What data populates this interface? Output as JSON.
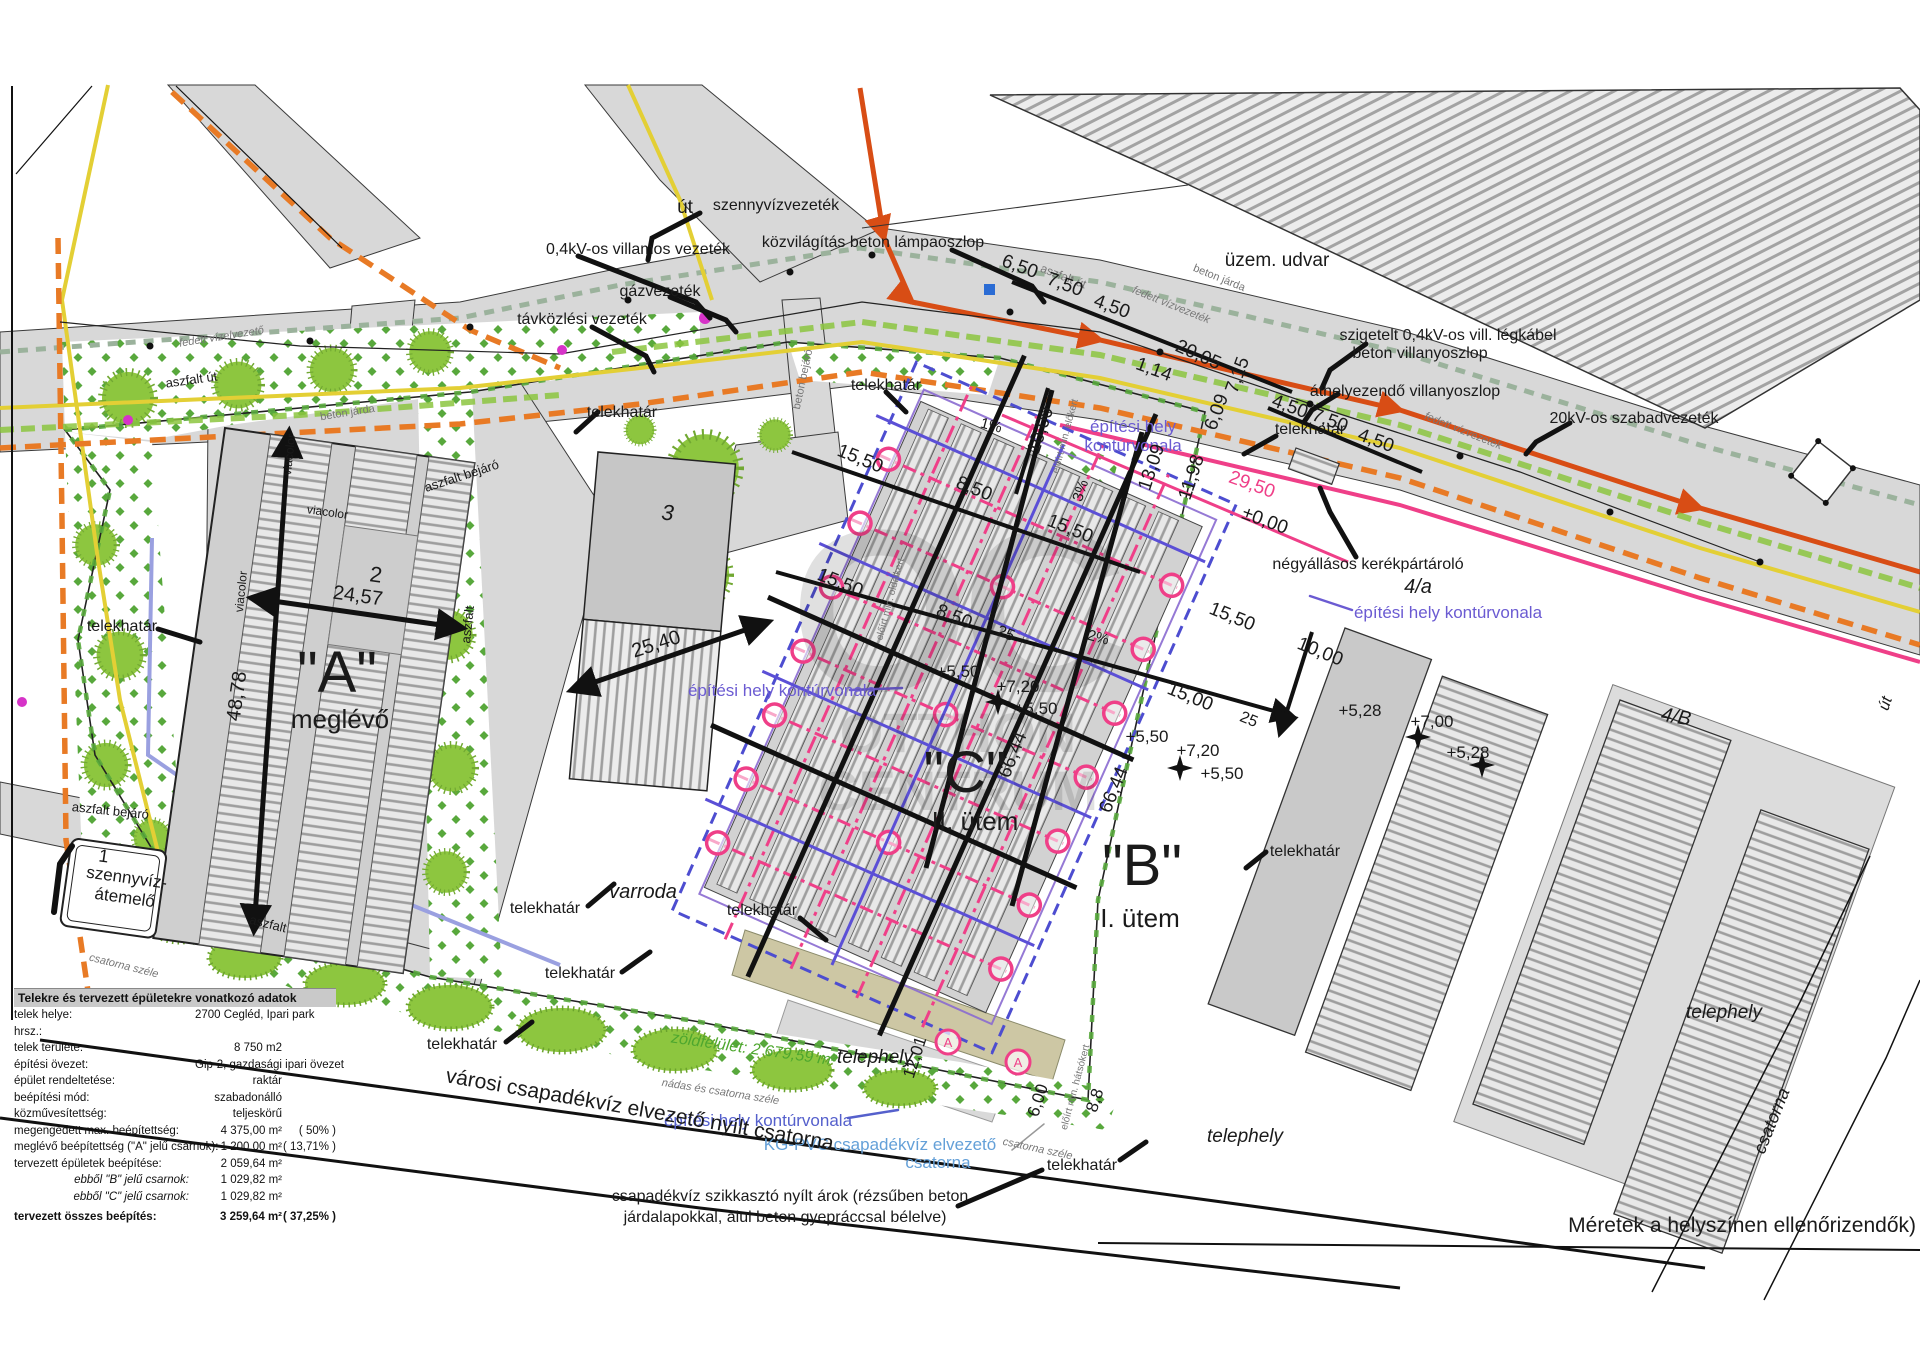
{
  "colors": {
    "accent_pink": "#ef3f88",
    "purple": "#6b5bd2",
    "blue_dash": "#4d4dd0",
    "kg_blue": "#64a0d8",
    "green_text": "#4ea72e",
    "utility_yellow": "#e3cf35",
    "utility_orange": "#e87a25",
    "utility_red": "#d84d15",
    "vegetation_green": "#8dc63f",
    "road_gray": "#d8d8d8"
  },
  "watermark": {
    "big": "OC",
    "l1": "OTTHON",
    "l2": "CENTRUM"
  },
  "labels": {
    "ut": "út",
    "ut_right": "út",
    "szennyviz": "szennyvízvezeték",
    "villamos": "0,4kV-os villamos vezeték",
    "gaz": "gázvezeték",
    "tavkozlesi": "távközlési vezeték",
    "kozvilagitas": "közvilágítás beton lámpaoszlop",
    "uzem_udvar": "üzem. udvar",
    "szigetelt1": "szigetelt 0,4kV-os vill. légkábel",
    "szigetelt2": "beton villanyoszlop",
    "athelyezendo": "áthelyezendő villanyoszlop",
    "szabadvezetek": "20kV-os szabadvezeték",
    "telekhatar": "telekhatár",
    "epitesi_hely": "építési hely kontúrvonala",
    "epitesi_hely1": "építési hely",
    "epitesi_hely2": "kontúrvonala",
    "negyallasos": "négyállásos kerékpártároló",
    "varroda": "varroda",
    "telephely": "telephely",
    "csatorna": "csatorna",
    "varosi": "városi csapadékvíz elvezető nyílt csatorna",
    "kgpvc1": "KG-PVC csapadékvíz elvezető",
    "kgpvc2": "csatorna",
    "szikkaszto1": "csapadékvíz szikkasztó nyílt árok (rézsűben beton",
    "szikkaszto2": "járdalapokkal, alul beton gyepráccsal bélelve)",
    "zoldfelulet": "zöldfelület: 2 679,59 m²",
    "nadas": "nádas és csatorna széle",
    "csatorna_szele": "csatorna széle",
    "meretek": "Méretek a helyszínen ellenőrizendők)",
    "aszfalt": "aszfalt",
    "aszfalt_ut": "aszfalt út",
    "aszfalt_bejaro": "aszfalt bejáró",
    "beton_jarda": "beton járda",
    "beton_bejaro": "beton bejáró",
    "viacolor": "viacolor",
    "fedett_vizvezetek": "fedett vízvezeték",
    "fedett_vizelvezeto": "fedett vízelvezető",
    "elokert": "előírt min. előkert",
    "oldalkert": "előírt min. oldalkert",
    "hatsokert": "előírt min. hátsókert",
    "marker_a": "A"
  },
  "buildings": {
    "a": "\"A\"",
    "a_sub": "meglévő",
    "b": "\"B\"",
    "b_sub": "I. ütem",
    "c": "\"C\"",
    "c_sub": "II. ütem",
    "n1": "1",
    "n2": "2",
    "n3": "3",
    "n4a": "4/a",
    "n4b": "4/B",
    "szv1": "szennyvíz-",
    "szv2": "átemelő"
  },
  "dims": {
    "d650": "6,50",
    "d750": "7,50",
    "d450": "4,50",
    "d2005": "20,05",
    "d715": "7,15",
    "d114": "1,14",
    "d1000": "10,00",
    "d1309": "13,09",
    "d1198": "11,98",
    "d2950": "29,50",
    "d000": "±0,00",
    "d609": "6,09",
    "d1550": "15,50",
    "d850": "8,50",
    "d25": "25",
    "d1500": "15,00",
    "p550": "+5,50",
    "p720": "+7,20",
    "d6644": "66,44",
    "d4878": "48,78",
    "d2457": "24,57",
    "d2540": "25,40",
    "p528": "+5,28",
    "p700": "+7,00",
    "d600": "6,00",
    "d1201": "12,01",
    "d88": "8,8",
    "pct1": "1%",
    "pct2": "2%",
    "pct3": "3%"
  },
  "table": {
    "title": "Telekre és tervezett épületekre vonatkozó adatok",
    "rows": [
      {
        "l": "telek helye:",
        "v": "2700 Cegléd, Ipari park",
        "p": ""
      },
      {
        "l": "hrsz.:",
        "v": "",
        "p": ""
      },
      {
        "l": "telek területe:",
        "v": "8 750 m2",
        "p": ""
      },
      {
        "l": "építési övezet:",
        "v": "Gip-2, gazdasági ipari övezet",
        "p": ""
      },
      {
        "l": "épület rendeltetése:",
        "v": "raktár",
        "p": ""
      },
      {
        "l": "beépítési mód:",
        "v": "szabadonálló",
        "p": ""
      },
      {
        "l": "közművesítettség:",
        "v": "teljeskörű",
        "p": ""
      },
      {
        "l": "megengedett max. beépítettség:",
        "v": "4 375,00 m²",
        "p": "(  50%  )"
      },
      {
        "l": "meglévő beépítettség (\"A\" jelű csarnok):",
        "v": "1 200,00 m²",
        "p": "( 13,71% )"
      },
      {
        "l": "tervezett épületek beépítése:",
        "v": "2 059,64 m²",
        "p": ""
      },
      {
        "l": "ebből \"B\" jelű csarnok:",
        "v": "1 029,82 m²",
        "p": ""
      },
      {
        "l": "ebből \"C\" jelű csarnok:",
        "v": "1 029,82 m²",
        "p": ""
      },
      {
        "l": "tervezett összes beépítés:",
        "v": "3 259,64 m²",
        "p": "( 37,25% )"
      }
    ]
  }
}
